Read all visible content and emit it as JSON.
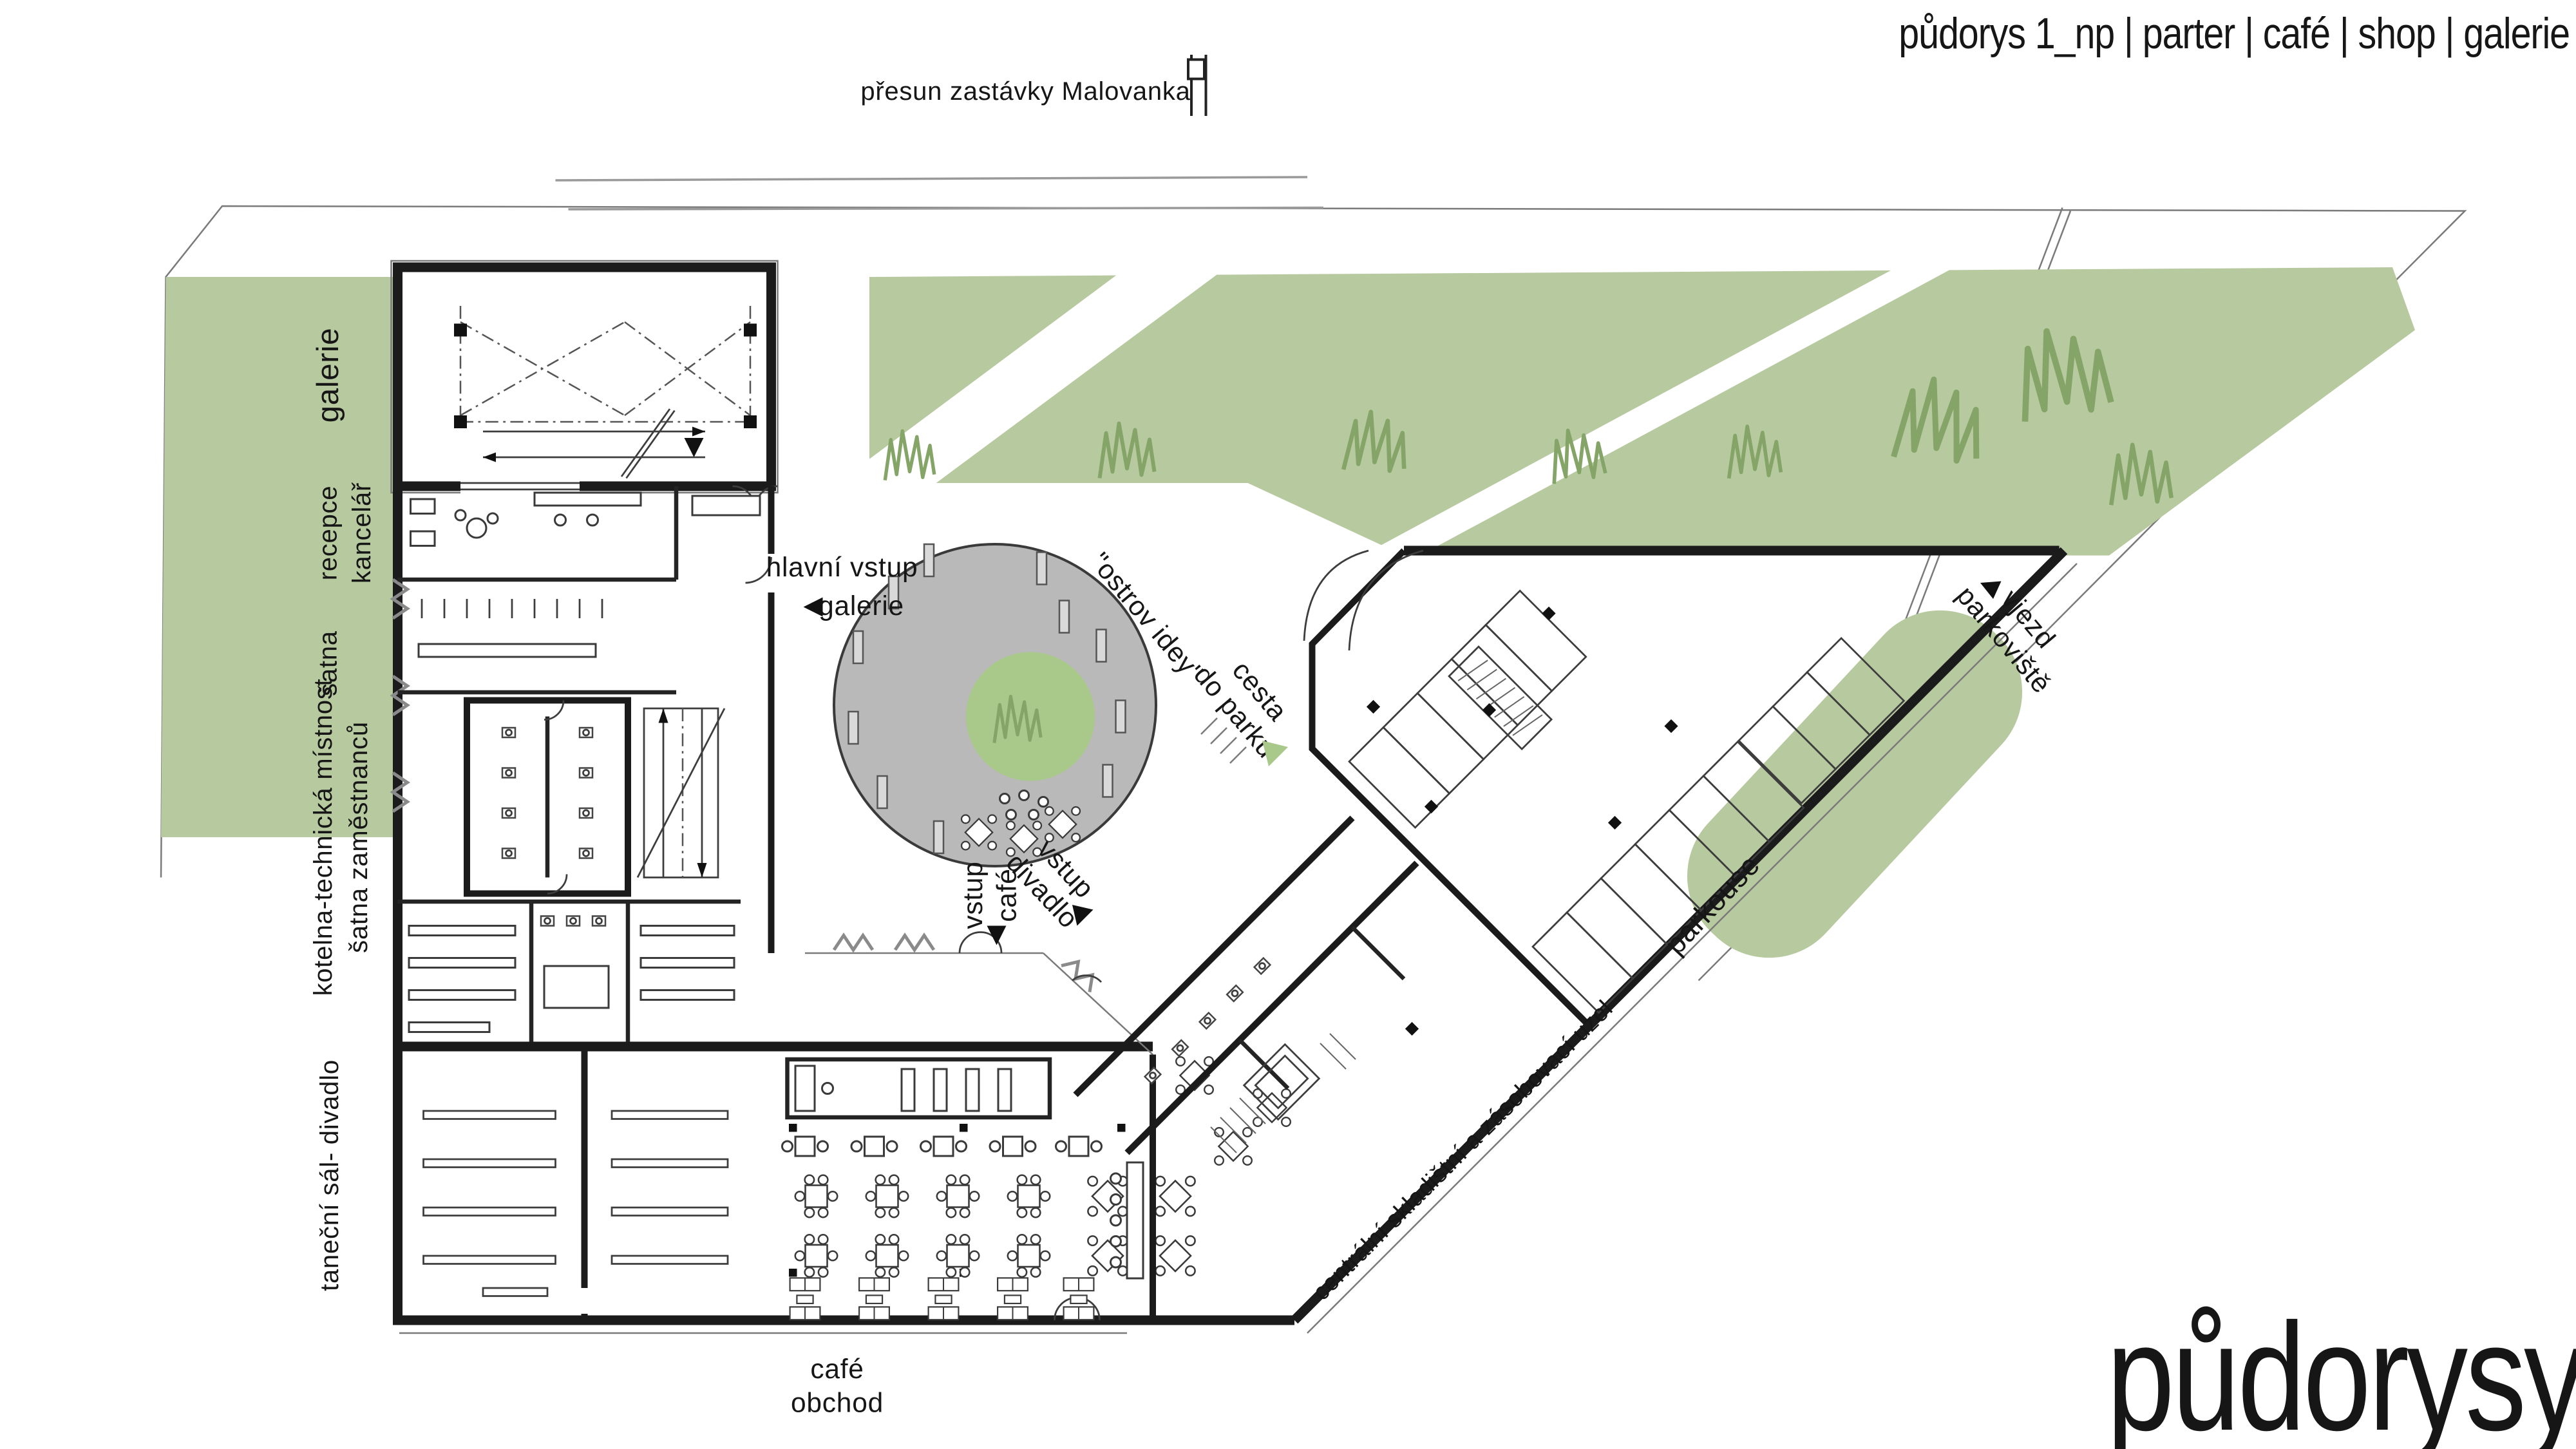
{
  "header": {
    "title": "půdorys 1_np | parter | café  | shop | galerie"
  },
  "site": {
    "bus_stop_label": "přesun zastávky Malovanka"
  },
  "rooms": {
    "galerie": "galerie",
    "recepce": "recepce",
    "kancelar": "kancelář",
    "satna": "šatna",
    "kotelna": "kotelna-technická místnost",
    "satna_zam": "šatna zaměstnanců",
    "tanecni_sal": "taneční sál- divadlo",
    "cafe": "café",
    "obchod": "obchod"
  },
  "plaza": {
    "ostrov_idey": "\"ostrov idey\"",
    "cesta_1": "cesta",
    "cesta_2": "do parku"
  },
  "entrances": {
    "hlavni_1": "hlavní vstup",
    "hlavni_2": "galerie",
    "vstup_cafe_1": "vstup",
    "vstup_cafe_2": "café",
    "vstup_divadlo_1": "vstup",
    "vstup_divadlo_2": "divadlo"
  },
  "parking": {
    "vjezd_1": "vjezd",
    "vjezd_2": "parkoviště",
    "parkouse": "parkouse"
  },
  "service": {
    "sklad_label": "centrální skladištní a zásobovací uzel"
  },
  "footer": {
    "big_title": "půdorysy"
  },
  "icons": {
    "bus_stop": "bus-stop-sign",
    "hlavni_arrow": "left-triangle",
    "cafe_arrow": "down-triangle",
    "divadlo_arrow": "diagonal-triangle",
    "vjezd_arrow": "diagonal-left-triangle",
    "park_path_arrow": "green-triangle"
  },
  "colors": {
    "park_green": "#b7c99e",
    "tree_green": "#85a468",
    "plaza_gray": "#b9b9b9",
    "plaza_inner_green": "#a9c98a",
    "wall_black": "#1b1b1b"
  }
}
